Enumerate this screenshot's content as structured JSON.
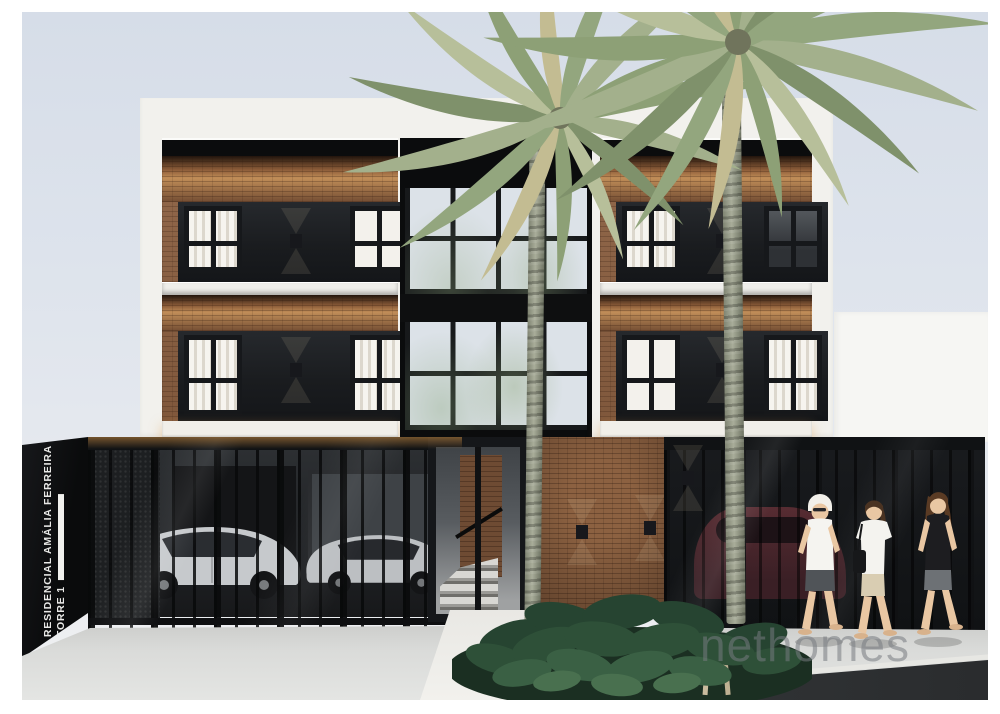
{
  "scene": {
    "description": "3D architectural rendering of a three-story residential building: two brick wings with dark window panels and wall sconces, a central glazed stairwell, black street-level gates with parked cars behind, tropical planting, two palm trees and three pedestrians on the sidewalk",
    "sign": {
      "line1": "RESIDENCIAL AMÁLIA FERREIRA",
      "line2": "TORRE 1"
    },
    "watermark": "nethomes",
    "counts": {
      "floors_visible": 3,
      "palm_trees": 2,
      "cars_behind_left_gate": 2,
      "cars_behind_right_gate": 1,
      "pedestrians": 3,
      "wall_sconces_on_facade": 4
    },
    "colors": {
      "sky": "#dde3ec",
      "white_wall": "#f2f1ed",
      "brick": "#8d6142",
      "brick_lit_glow": "#e2a252",
      "dark_panel": "#1a1c1f",
      "roof_band": "#0b0c0d",
      "glass_pane": "#dce2e8",
      "gate": "#17191c",
      "foliage": "#2a4733",
      "palm_foliage": "#9aa884",
      "palm_trunk": "#979b87",
      "sidewalk": "#d6d7d5",
      "road": "#343739",
      "car_silver": "#c6c9cc",
      "car_dark_red": "#4a262c",
      "sign_text": "#e9e9e7",
      "watermark_gray": "#767a7f"
    }
  }
}
